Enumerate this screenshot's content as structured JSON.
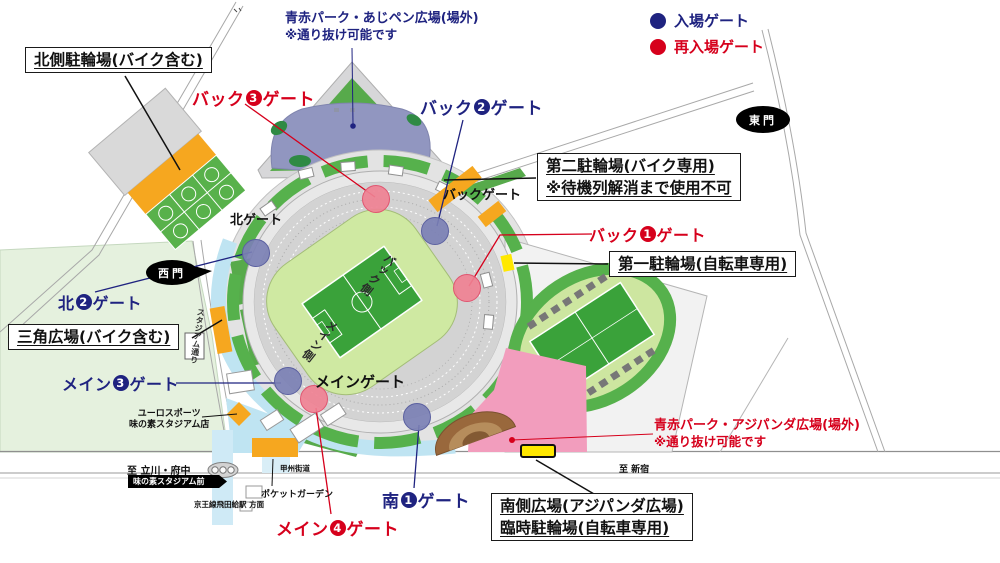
{
  "legend": {
    "entry": "入場ゲート",
    "reentry": "再入場ゲート"
  },
  "colors": {
    "entry_navy": "#1f2380",
    "reentry_red": "#d6001c",
    "orange": "#f6a71f",
    "yellow": "#ffe800",
    "pink": "#f29dbd",
    "plaza_purple": "#9196c0",
    "pitch_green": "#3aa23a",
    "ring_green": "#56b14c",
    "walkway_blue": "#bfe4f2"
  },
  "notes": {
    "north_plaza": {
      "line1": "青赤パーク・あじペン広場(場外)",
      "line2": "※通り抜け可能です"
    },
    "south_plaza": {
      "line1": "青赤パーク・アジパンダ広場(場外)",
      "line2": "※通り抜け可能です"
    }
  },
  "boxes": {
    "north_parking": {
      "line1": "北側駐輪場(バイク含む)"
    },
    "second_parking": {
      "line1": "第二駐輪場(バイク専用)",
      "line2": "※待機列解消まで使用不可"
    },
    "first_parking": {
      "line1": "第一駐輪場(自転車専用)"
    },
    "triangle_plaza": {
      "line1": "三角広場(バイク含む)"
    },
    "south_plaza_parking": {
      "line1": "南側広場(アジパンダ広場)",
      "line2": "臨時駐輪場(自転車専用)"
    }
  },
  "gates": {
    "back3": {
      "prefix": "バック",
      "number": "3",
      "suffix": "ゲート",
      "type": "reentry"
    },
    "back2": {
      "prefix": "バック",
      "number": "2",
      "suffix": "ゲート",
      "type": "entry"
    },
    "back1": {
      "prefix": "バック",
      "number": "1",
      "suffix": "ゲート",
      "type": "reentry"
    },
    "kita2": {
      "prefix": "北",
      "number": "2",
      "suffix": "ゲート",
      "type": "entry"
    },
    "main3": {
      "prefix": "メイン",
      "number": "3",
      "suffix": "ゲート",
      "type": "entry"
    },
    "main4": {
      "prefix": "メイン",
      "number": "4",
      "suffix": "ゲート",
      "type": "reentry"
    },
    "minami1": {
      "prefix": "南",
      "number": "1",
      "suffix": "ゲート",
      "type": "entry"
    }
  },
  "plain_gates": {
    "kita": "北ゲート",
    "back": "バックゲート",
    "main": "メインゲート"
  },
  "doors": {
    "west": "西門",
    "east": "東門",
    "bus_stop": "味の素スタジアム前"
  },
  "map_texts": {
    "stadium_street": "スタジアム通り",
    "back_side": "バック側",
    "main_side": "メイン側",
    "euro_line1": "ユーロスポーツ",
    "euro_line2": "味の素スタジアム店",
    "to_tachikawa": "至 立川・府中",
    "koshu_kaido": "甲州街道",
    "pocket_garden": "ポケットガーデン",
    "keio_station": "京王線飛田給駅 方面",
    "to_shinjuku": "至 新宿"
  }
}
